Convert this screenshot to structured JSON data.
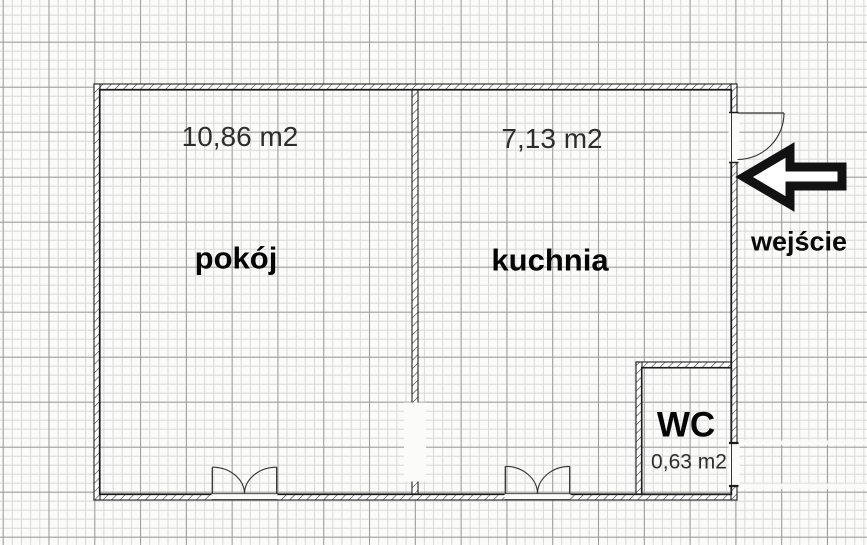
{
  "floorplan": {
    "rooms": [
      {
        "name": "pokój",
        "area": "10,86 m2"
      },
      {
        "name": "kuchnia",
        "area": "7,13 m2"
      },
      {
        "name": "WC",
        "area": "0,63 m2"
      }
    ],
    "entrance": {
      "label": "wejście",
      "icon": "arrow-left-icon"
    },
    "colors": {
      "paper": "#fbfbfa",
      "grid_fine": "#d8d8d8",
      "grid_major": "#9b9b9b",
      "wall_line": "#1c1c1c",
      "text": "#2d2d2d",
      "arrow": "#121212"
    }
  }
}
